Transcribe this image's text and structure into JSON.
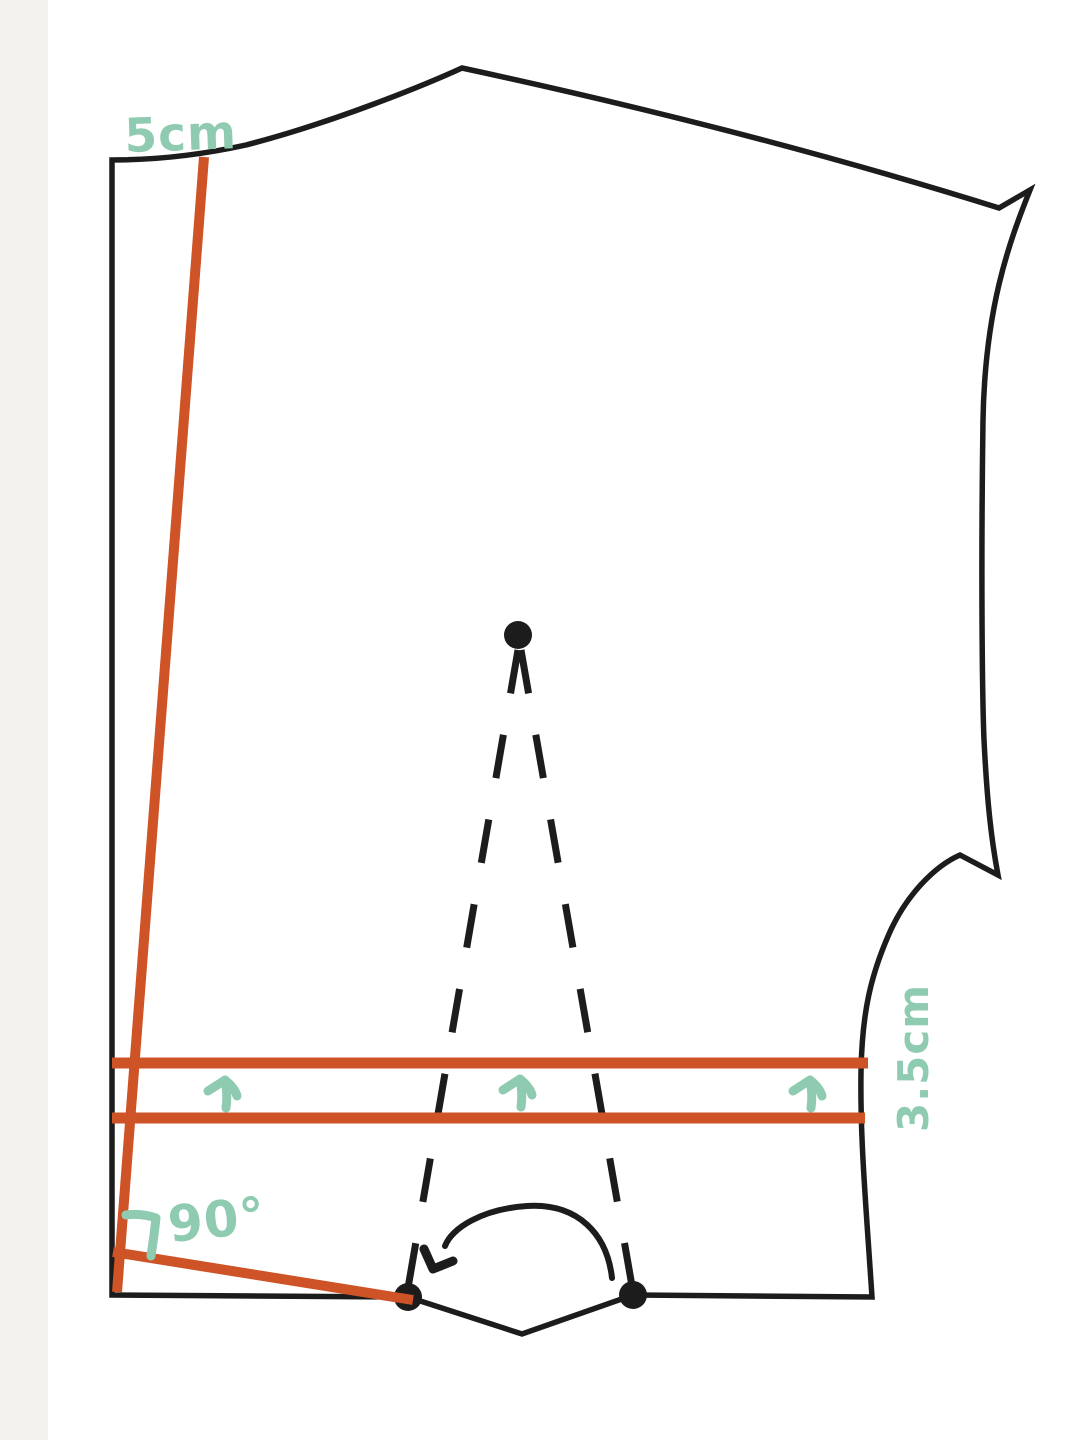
{
  "diagram": {
    "kind": "sewing-pattern-adjustment",
    "labels": {
      "shoulder_measure": "5cm",
      "side_measure": "3.5cm",
      "angle_measure": "90°"
    },
    "colors": {
      "outline": "#1C1C1C",
      "adjustment_line": "#CE5327",
      "annotation": "#8FCBB1",
      "background": "#FFFFFF",
      "left_band": "#F4F2EE"
    },
    "arrow_up_count": 3
  }
}
